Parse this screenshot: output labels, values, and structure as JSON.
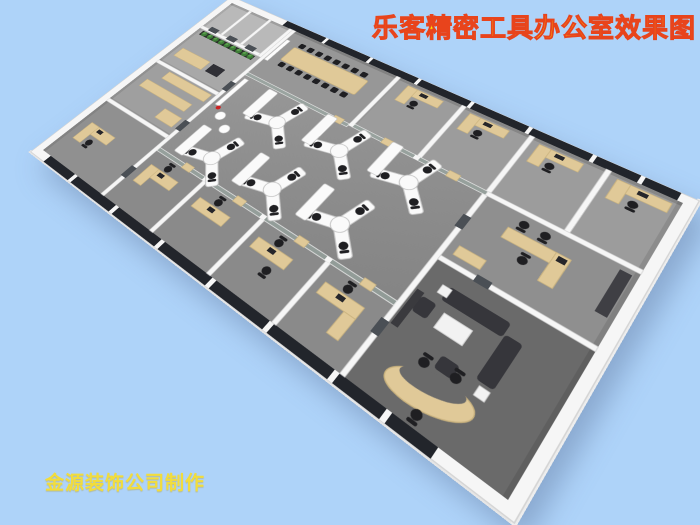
{
  "title": {
    "text": "乐客精密工具办公室效果图"
  },
  "credit": {
    "text": "金源装饰公司制作"
  },
  "palette": {
    "background": "#aed3f9",
    "title_fill": "#ffe600",
    "title_outline": "#e8441c",
    "credit_fill": "#f2dd3c",
    "floor": "#8d8d8d",
    "floor_light": "#a6a6a6",
    "floor_dark": "#6a6a6a",
    "wall": "#f6f6f6",
    "wall_shade": "#d9d9d9",
    "window": "#22252b",
    "glass": "rgba(158,178,170,0.5)",
    "wood": "#e0c998",
    "wood_dark": "#c9b27e",
    "chair": "#1f1f22",
    "sofa": "#36363b",
    "plant": "#3e7c38",
    "plant_light": "#5aa04c",
    "white_furniture": "#fafafa",
    "door": "#4a4f55",
    "red_accent": "#cc2222"
  },
  "scene": {
    "type": "3d-isometric-office-floorplan-render",
    "objects": [
      "conference-room",
      "meeting-table",
      "conference-chairs",
      "open-plan-y-desk-clusters",
      "storage-cabinets",
      "presentation-board",
      "ne-private-offices",
      "curtain-wall-windows",
      "glass-partitions",
      "plant-row",
      "white-stools",
      "left-storage-rooms",
      "bottom-private-offices",
      "manager-office",
      "executive-office",
      "sofa-set",
      "coffee-table",
      "kidney-shaped-desk"
    ]
  }
}
